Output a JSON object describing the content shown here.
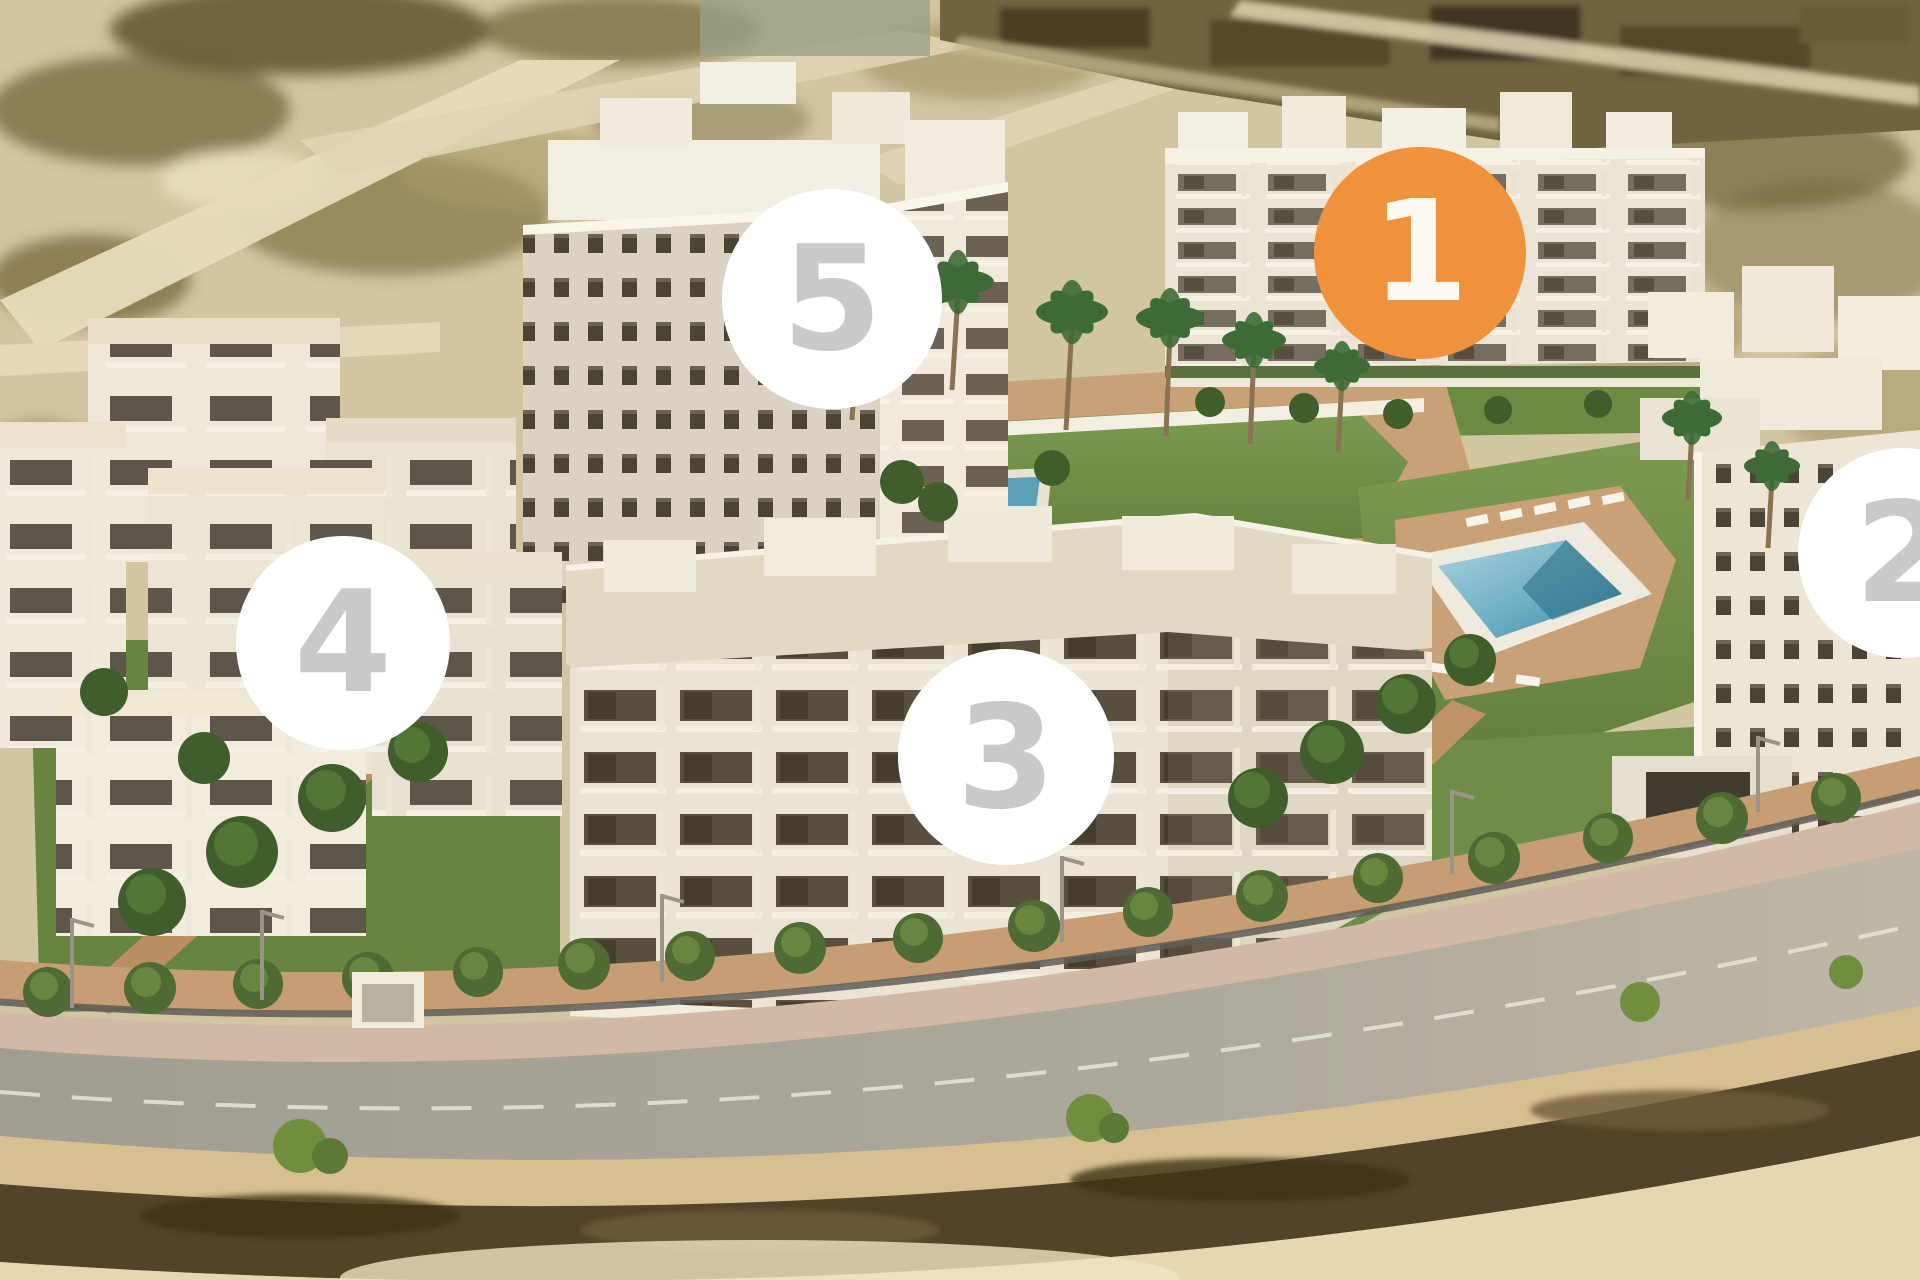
{
  "page": {
    "title": "Aerial render of 5-phase residential apartment complex"
  },
  "markers": [
    {
      "id": "phase-1",
      "label": "1",
      "variant": "active",
      "cx": 1420,
      "cy": 253,
      "d": 212
    },
    {
      "id": "phase-2",
      "label": "2",
      "variant": "default",
      "cx": 1903,
      "cy": 553,
      "d": 210
    },
    {
      "id": "phase-3",
      "label": "3",
      "variant": "default",
      "cx": 1006,
      "cy": 757,
      "d": 216
    },
    {
      "id": "phase-4",
      "label": "4",
      "variant": "default",
      "cx": 343,
      "cy": 643,
      "d": 214
    },
    {
      "id": "phase-5",
      "label": "5",
      "variant": "default",
      "cx": 832,
      "cy": 299,
      "d": 220
    }
  ],
  "colors": {
    "marker_active_bg": "#F0913C",
    "marker_active_text": "#FDFAF2",
    "marker_default_bg": "#FFFFFF",
    "marker_default_text": "#C9C9C9",
    "sand": "#D2C5A2",
    "lawn": "#6E8C44",
    "pool": "#5FA6BC",
    "road": "#A9A59B",
    "building": "#EFE8DA"
  }
}
